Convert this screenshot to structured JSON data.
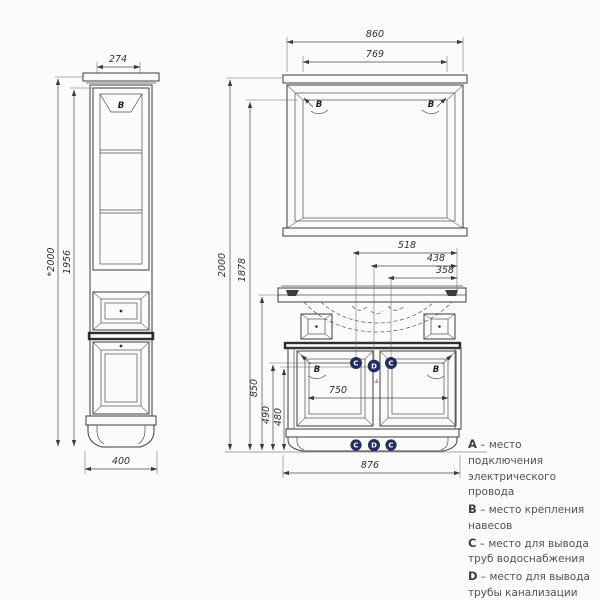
{
  "colors": {
    "line": "#3d3d3d",
    "marker_fill": "#232d63",
    "marker_text": "#ffffff",
    "legend_text": "#50505a",
    "background": "#fbfbf9"
  },
  "markers": {
    "hinge": "B",
    "water": "C",
    "drain": "D"
  },
  "dims": {
    "cabinet_top_width": "274",
    "cabinet_total_height": "*2000",
    "cabinet_body_height": "1956",
    "cabinet_base_width": "400",
    "mirror_outer_width": "860",
    "mirror_inner_width": "769",
    "set_total_height": "2000",
    "mirror_top_height": "1878",
    "water_left_offset": "518",
    "drain_offset": "438",
    "water_right_offset": "358",
    "vanity_height": "850",
    "water_outlet_height": "490",
    "drain_outlet_height": "480",
    "doors_width": "750",
    "vanity_width": "876"
  },
  "legend": {
    "items": [
      {
        "letter": "А",
        "text": "– место подключения электрического провода"
      },
      {
        "letter": "B",
        "text": "– место крепления навесов"
      },
      {
        "letter": "C",
        "text": "– место для вывода труб водоснабжения"
      },
      {
        "letter": "D",
        "text": "– место для вывода трубы канализации"
      }
    ]
  }
}
